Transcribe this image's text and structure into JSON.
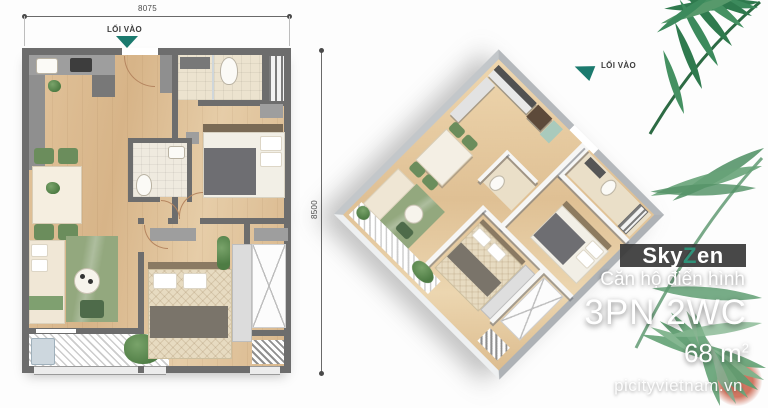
{
  "plan_2d": {
    "dim_width": "8075",
    "dim_height": "8500",
    "entrance_label": "LỐI VÀO"
  },
  "plan_3d": {
    "entrance_label": "LỐI VÀO"
  },
  "branding": {
    "logo_pre": "Sky",
    "logo_accent": "Z",
    "logo_post": "en",
    "tagline": "Căn hộ điển hình",
    "unit_type": "3PN 2WC",
    "area_value": "68 m",
    "area_exponent": "2",
    "website": "picityvietnam.vn"
  },
  "colors": {
    "entrance_arrow": "#1b7a6e",
    "logo_accent_green": "#2f9279",
    "banner_bg": "#383838",
    "palm_dark": "#2f7a4e",
    "palm_light": "#6aa67b",
    "wall_2d": "#6d6d6d",
    "wood_floor": "#ddbd93"
  },
  "icons": {
    "entrance_arrow_2d": "triangle-down",
    "entrance_arrow_3d": "triangle-left",
    "palm_frond": "leaf-fan"
  }
}
